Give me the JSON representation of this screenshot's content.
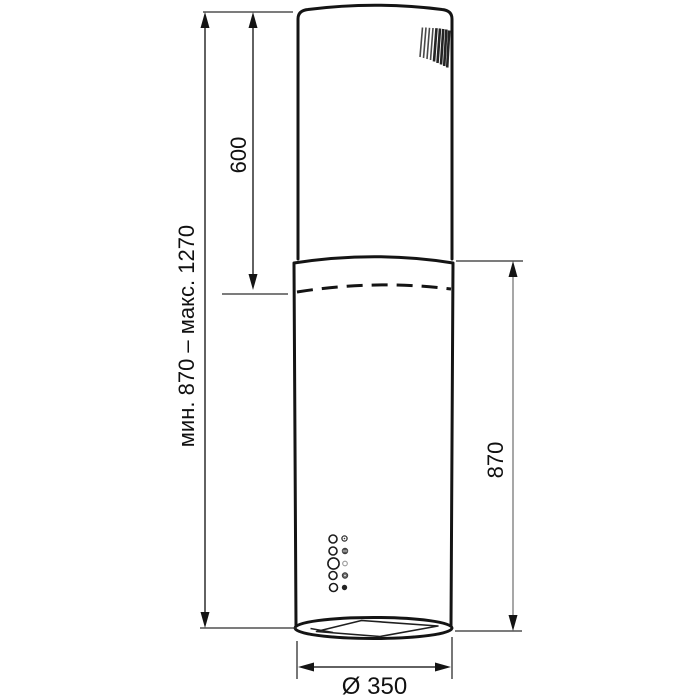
{
  "diagram": {
    "dims": {
      "height_range": "мин. 870 – макс. 1270",
      "upper_section": "600",
      "lower_section": "870",
      "diameter": "Ø 350"
    },
    "colors": {
      "background": "#ffffff",
      "outline": "#141414",
      "dimension_line": "#2e2e2e",
      "dimension_line_gray": "#8a8a8a",
      "label_text": "#111111"
    },
    "controls": {
      "button_count": 5,
      "indicator_count": 5
    }
  }
}
